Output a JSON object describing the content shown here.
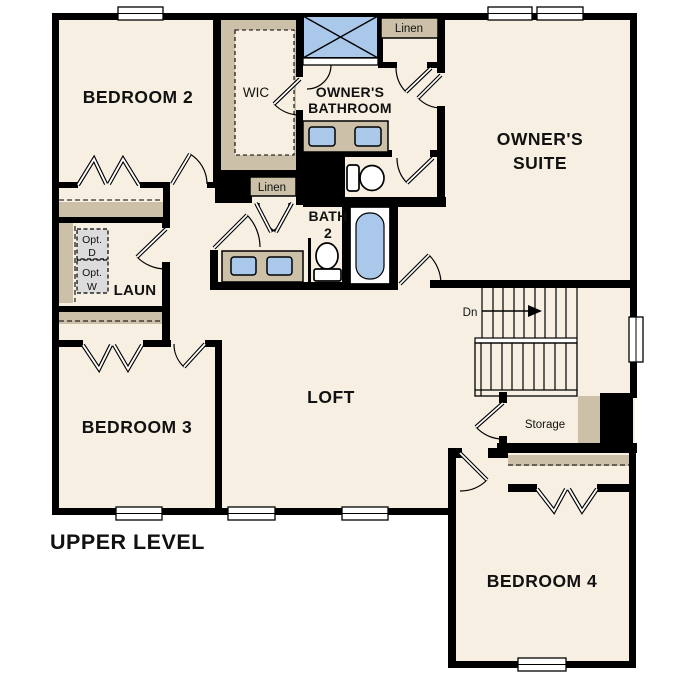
{
  "plan": {
    "title": "UPPER LEVEL",
    "labels": {
      "bedroom2": "BEDROOM 2",
      "bedroom3": "BEDROOM 3",
      "bedroom4": "BEDROOM 4",
      "owners_suite_line1": "OWNER'S",
      "owners_suite_line2": "SUITE",
      "owners_bath_line1": "OWNER'S",
      "owners_bath_line2": "BATHROOM",
      "loft": "LOFT",
      "wic": "WIC",
      "laundry": "LAUN",
      "bath2_line1": "BATH",
      "bath2_line2": "2",
      "linen_upper": "Linen",
      "linen_hall": "Linen",
      "storage": "Storage",
      "stairs_down": "Dn",
      "opt_dryer_line1": "Opt.",
      "opt_dryer_line2": "D",
      "opt_washer_line1": "Opt.",
      "opt_washer_line2": "W"
    },
    "colors": {
      "background": "#ffffff",
      "floor": "#f7f0e2",
      "wall": "#000000",
      "casework_tan": "#ccc1a8",
      "fixture_blue": "#a9c8ea",
      "appliance_gray": "#dcdcdc",
      "text": "#111111"
    }
  }
}
